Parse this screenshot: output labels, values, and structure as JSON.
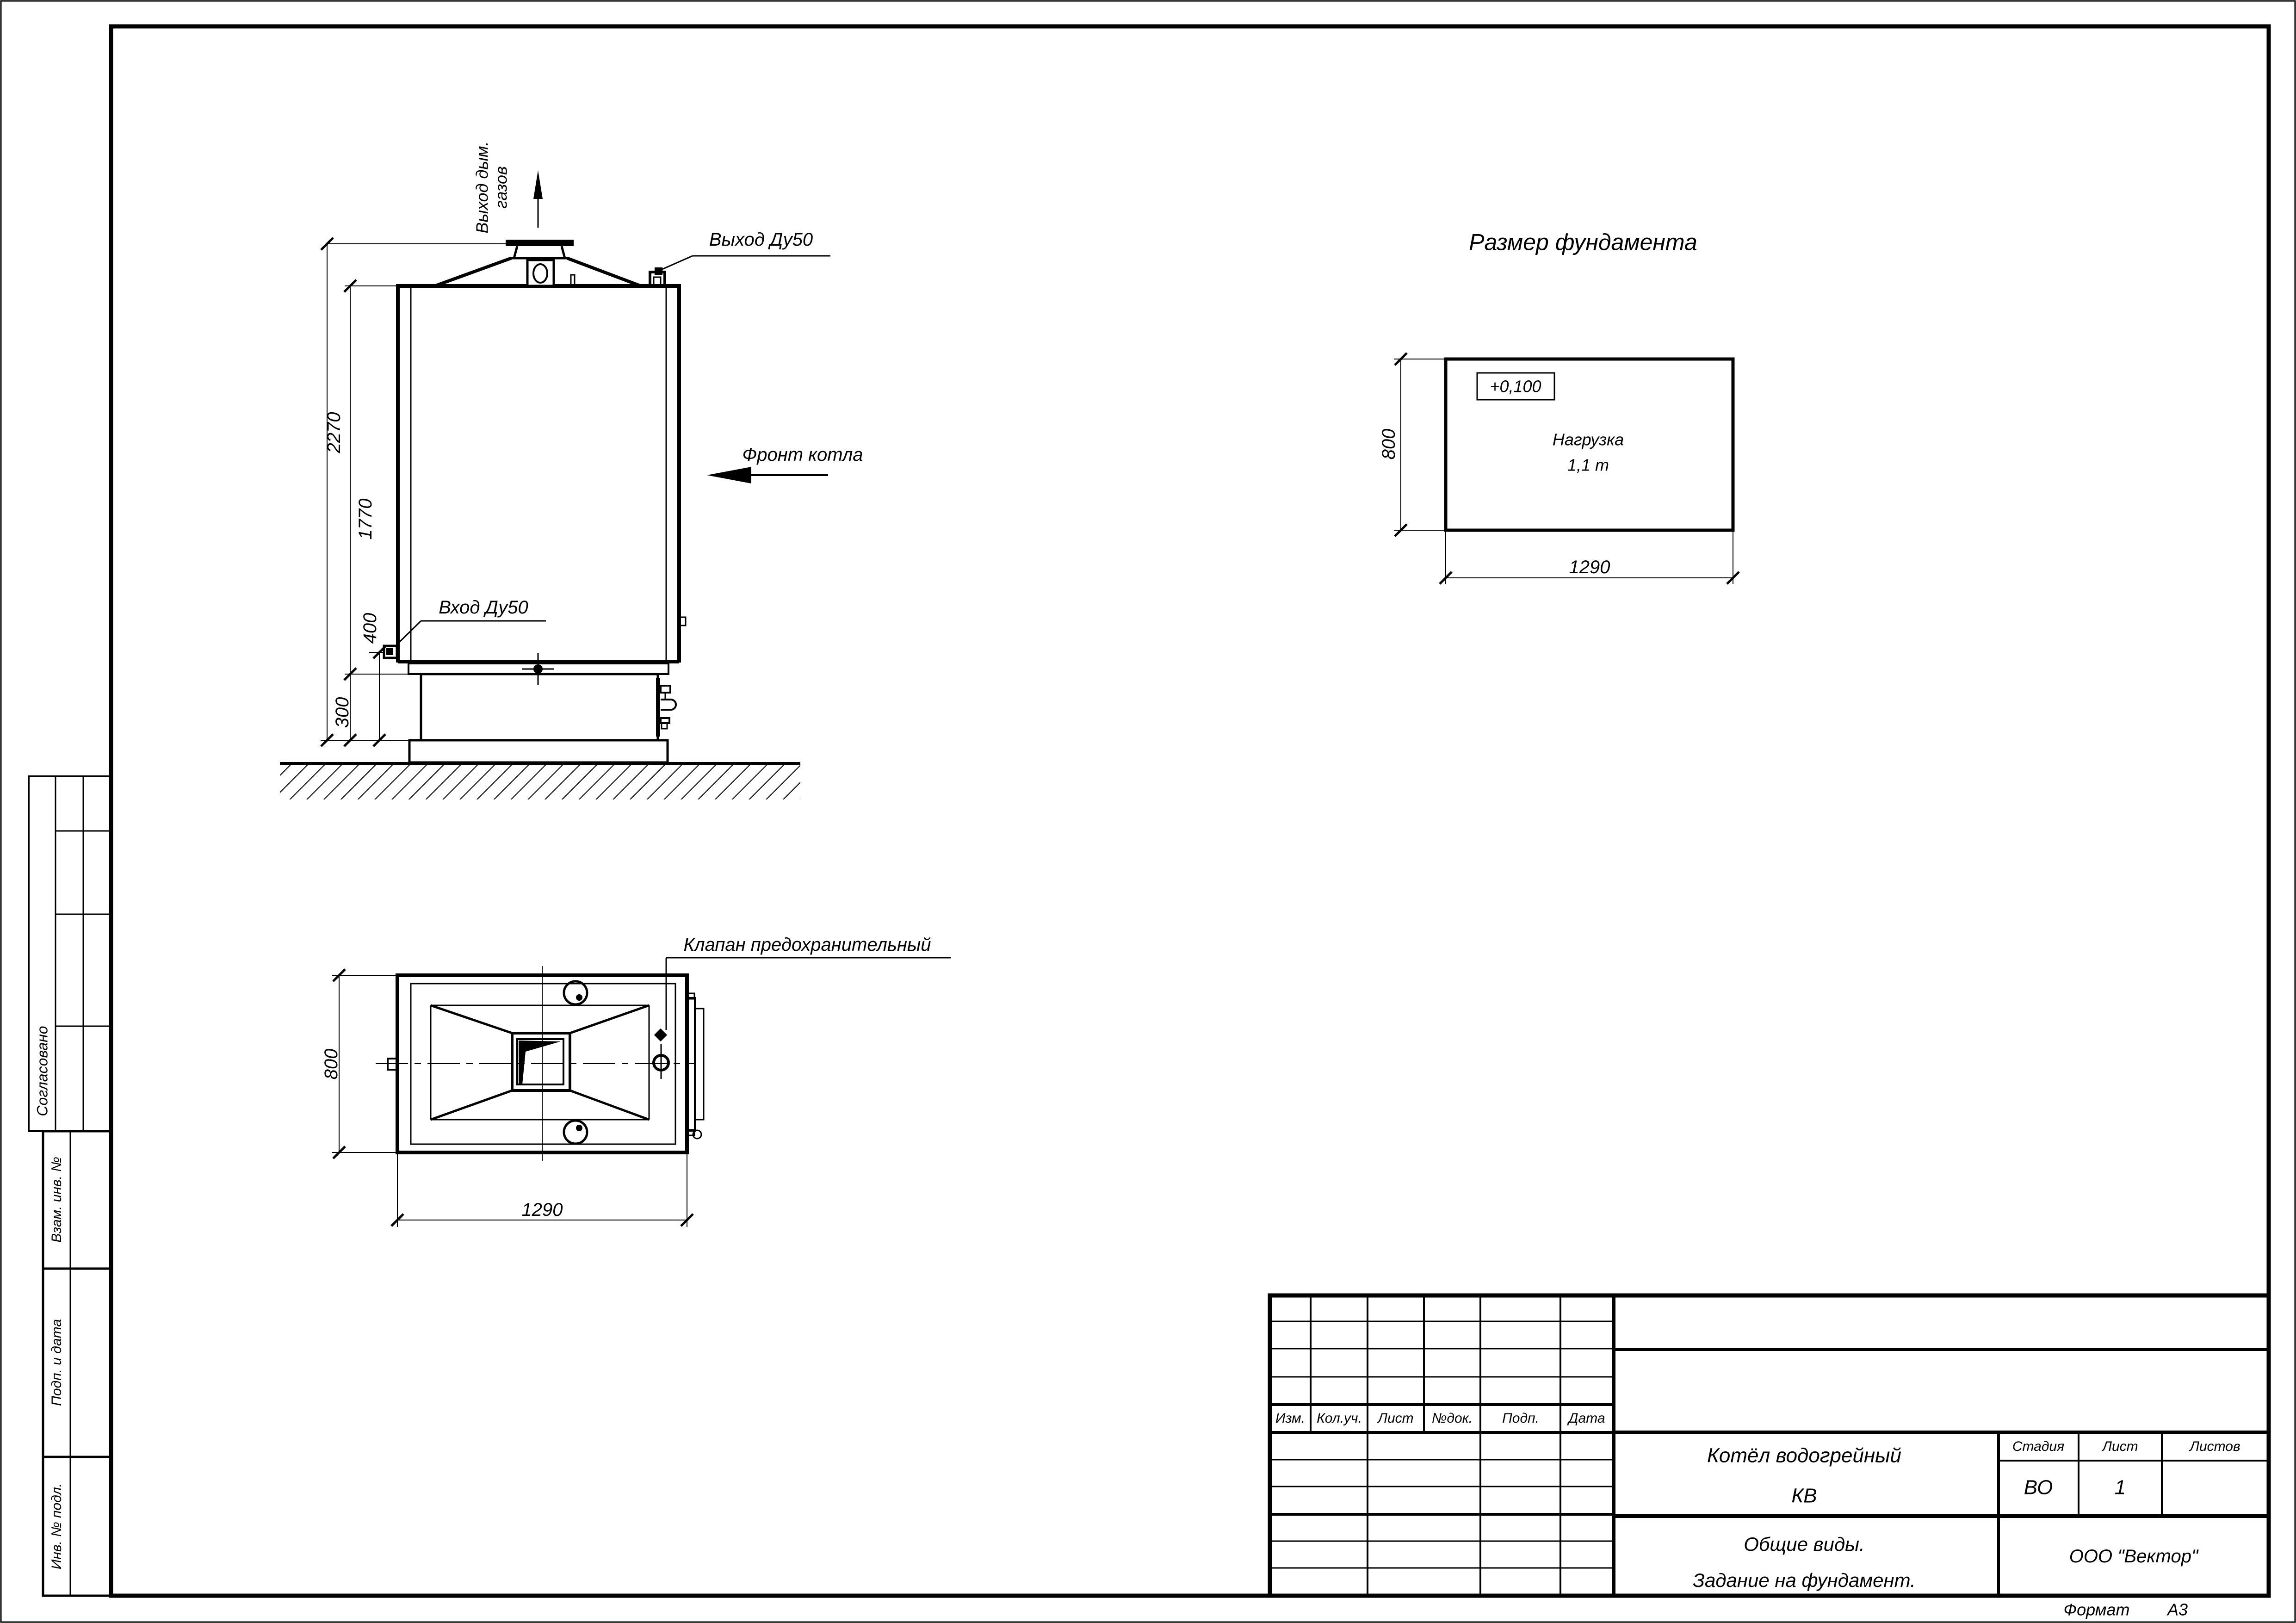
{
  "front_view": {
    "flue_label_line1": "Выход дым.",
    "flue_label_line2": "газов",
    "outlet_label": "Выход Ду50",
    "inlet_label": "Вход Ду50",
    "front_label": "Фронт котла",
    "dims": {
      "total_height": "2270",
      "body_height": "1770",
      "inlet_height": "400",
      "plinth_height": "300"
    }
  },
  "plan_view": {
    "valve_label": "Клапан предохранительный",
    "dims": {
      "width": "800",
      "length": "1290"
    }
  },
  "foundation_view": {
    "title": "Размер фундамента",
    "elevation_mark": "+0,100",
    "load_line1": "Нагрузка",
    "load_line2": "1,1 т",
    "dims": {
      "width": "800",
      "length": "1290"
    }
  },
  "side_stamp": {
    "approved": "Согласовано",
    "replaced_inv": "Взам. инв. №",
    "sign_date": "Подп. и дата",
    "orig_inv": "Инв. № подл."
  },
  "title_block": {
    "revision_headers": [
      "Изм.",
      "Кол.уч.",
      "Лист",
      "№док.",
      "Подп.",
      "Дата"
    ],
    "doc_title_line1": "Котёл водогрейный",
    "doc_title_line2": "КВ",
    "subtitle_line1": "Общие виды.",
    "subtitle_line2": "Задание на фундамент.",
    "stage_label": "Стадия",
    "sheet_label": "Лист",
    "sheets_label": "Листов",
    "stage_value": "ВО",
    "sheet_value": "1",
    "sheets_value": "",
    "company": "ООО \"Вектор\"",
    "format_label": "Формат",
    "format_value": "А3"
  }
}
